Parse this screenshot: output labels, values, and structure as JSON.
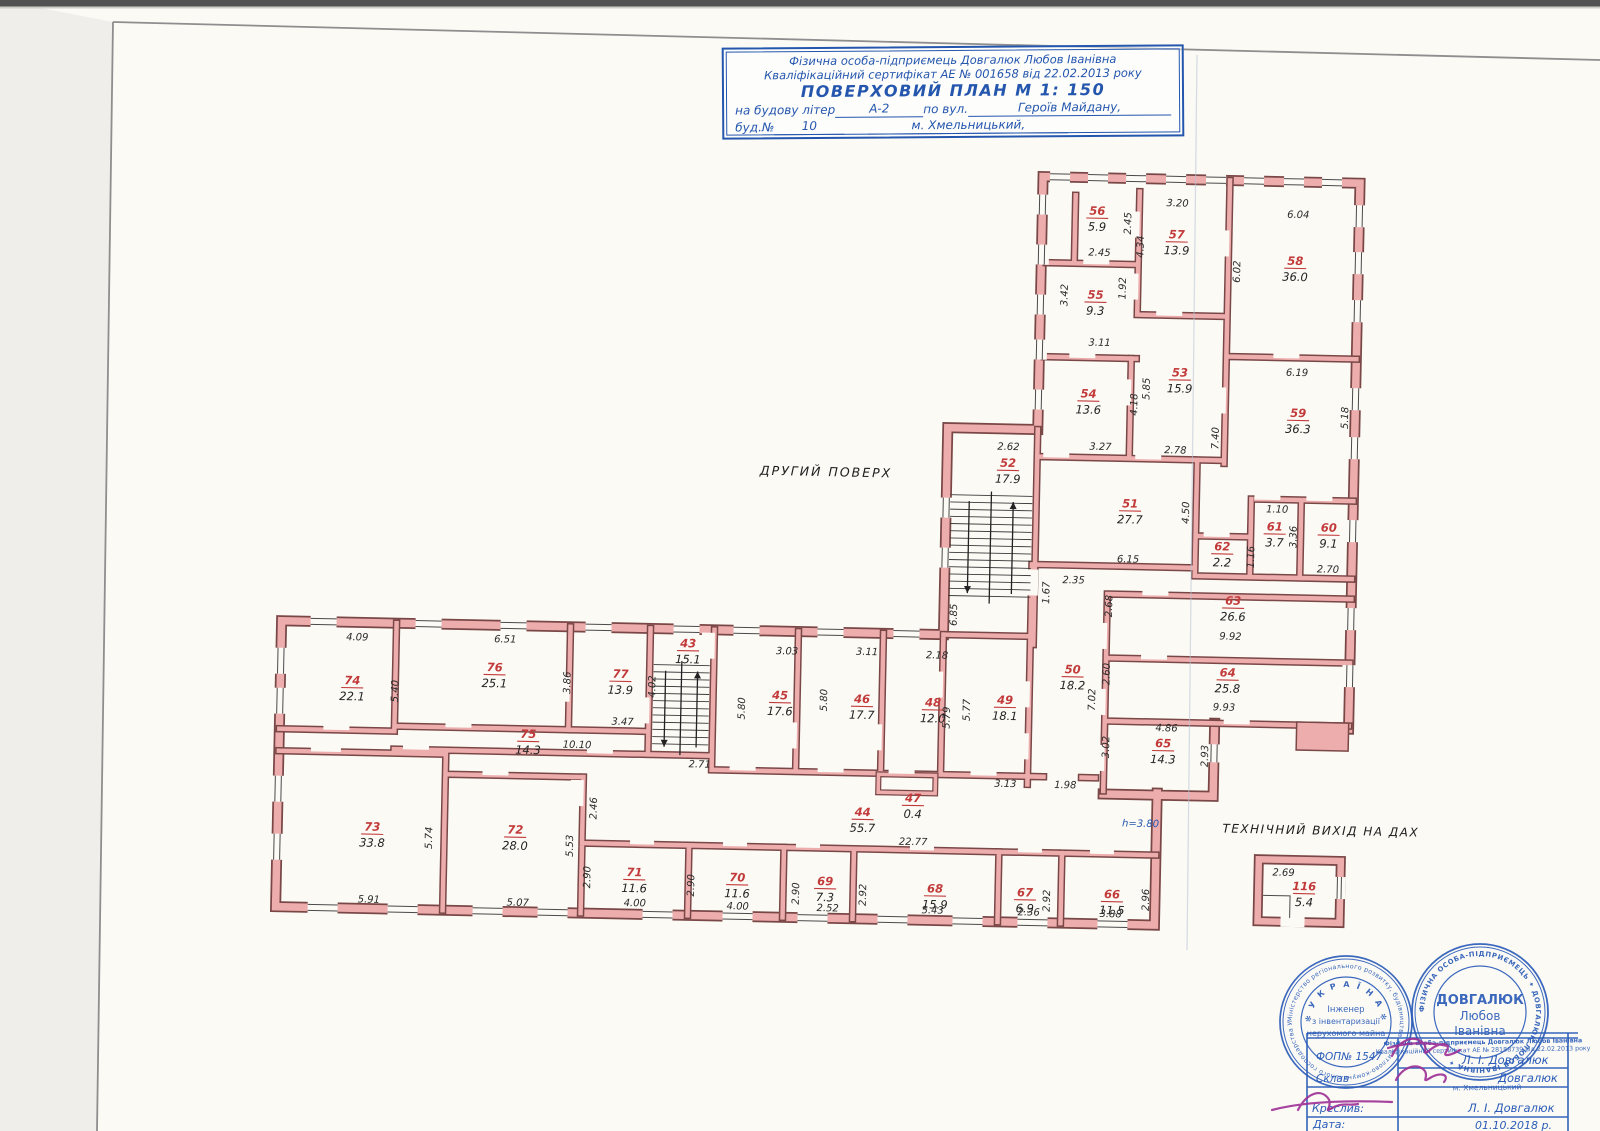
{
  "title_block": {
    "line1": "Фізична особа-підприємець Довгалюк Любов Іванівна",
    "line2": "Кваліфікаційний сертифікат АЕ №  001658  від  22.02.2013  року",
    "line3": "ПОВЕРХОВИЙ  ПЛАН    М 1: 150",
    "line4a": "на  будову  літер",
    "line4b": "А-2",
    "line4c": "по  вул.",
    "line4d": "Героїв  Майдану,",
    "line5a": "буд.№",
    "line5b": "10",
    "line5c": "м.  Хмельницький,"
  },
  "plan": {
    "floor_label": "ДРУГИЙ  ПОВЕРХ",
    "roof_label": "ТЕХНІЧНИЙ  ВИХІД  НА  ДАХ",
    "rooms": [
      {
        "n": "74",
        "a": "22.1",
        "x": 355,
        "y": 694
      },
      {
        "n": "76",
        "a": "25.1",
        "x": 497,
        "y": 678
      },
      {
        "n": "77",
        "a": "13.9",
        "x": 623,
        "y": 682
      },
      {
        "n": "43",
        "a": "15.1",
        "x": 690,
        "y": 650
      },
      {
        "n": "75",
        "a": "14.3",
        "x": 532,
        "y": 744
      },
      {
        "n": "45",
        "a": "17.6",
        "x": 783,
        "y": 700
      },
      {
        "n": "46",
        "a": "17.7",
        "x": 865,
        "y": 702
      },
      {
        "n": "48",
        "a": "12.0",
        "x": 936,
        "y": 704
      },
      {
        "n": "49",
        "a": "18.1",
        "x": 1008,
        "y": 700
      },
      {
        "n": "44",
        "a": "55.7",
        "x": 868,
        "y": 815
      },
      {
        "n": "47",
        "a": "0.4",
        "x": 918,
        "y": 800
      },
      {
        "n": "73",
        "a": "33.8",
        "x": 378,
        "y": 840
      },
      {
        "n": "72",
        "a": "28.0",
        "x": 521,
        "y": 840
      },
      {
        "n": "71",
        "a": "11.6",
        "x": 641,
        "y": 880
      },
      {
        "n": "70",
        "a": "11.6",
        "x": 744,
        "y": 883
      },
      {
        "n": "69",
        "a": "7.3",
        "x": 832,
        "y": 885
      },
      {
        "n": "68",
        "a": "15.9",
        "x": 942,
        "y": 890
      },
      {
        "n": "67",
        "a": "6.9",
        "x": 1032,
        "y": 892
      },
      {
        "n": "66",
        "a": "11.5",
        "x": 1119,
        "y": 892
      },
      {
        "n": "56",
        "a": "5.9",
        "x": 1090,
        "y": 209
      },
      {
        "n": "57",
        "a": "13.9",
        "x": 1170,
        "y": 231
      },
      {
        "n": "58",
        "a": "36.0",
        "x": 1289,
        "y": 255
      },
      {
        "n": "55",
        "a": "9.3",
        "x": 1090,
        "y": 293
      },
      {
        "n": "54",
        "a": "13.6",
        "x": 1085,
        "y": 392
      },
      {
        "n": "53",
        "a": "15.9",
        "x": 1176,
        "y": 369
      },
      {
        "n": "59",
        "a": "36.3",
        "x": 1295,
        "y": 407
      },
      {
        "n": "52",
        "a": "17.9",
        "x": 1006,
        "y": 463
      },
      {
        "n": "51",
        "a": "27.7",
        "x": 1129,
        "y": 501
      },
      {
        "n": "62",
        "a": "2.2",
        "x": 1222,
        "y": 542
      },
      {
        "n": "61",
        "a": "3.7",
        "x": 1274,
        "y": 521
      },
      {
        "n": "60",
        "a": "9.1",
        "x": 1328,
        "y": 521
      },
      {
        "n": "50",
        "a": "18.2",
        "x": 1075,
        "y": 668
      },
      {
        "n": "63",
        "a": "26.6",
        "x": 1234,
        "y": 596
      },
      {
        "n": "64",
        "a": "25.8",
        "x": 1230,
        "y": 668
      },
      {
        "n": "65",
        "a": "14.3",
        "x": 1167,
        "y": 740
      },
      {
        "n": "116",
        "a": "5.4",
        "x": 1311,
        "y": 880
      }
    ],
    "dims": [
      {
        "v": "4.09",
        "x": 359,
        "y": 650
      },
      {
        "v": "6.51",
        "x": 507,
        "y": 649
      },
      {
        "v": "5.40",
        "x": 401,
        "y": 700,
        "r": 1
      },
      {
        "v": "3.86",
        "x": 573,
        "y": 688,
        "r": 1
      },
      {
        "v": "4.02",
        "x": 658,
        "y": 690,
        "r": 1
      },
      {
        "v": "3.47",
        "x": 626,
        "y": 729
      },
      {
        "v": "10.10",
        "x": 581,
        "y": 753
      },
      {
        "v": "2.71",
        "x": 704,
        "y": 770
      },
      {
        "v": "3.03",
        "x": 789,
        "y": 655
      },
      {
        "v": "3.11",
        "x": 869,
        "y": 654
      },
      {
        "v": "2.18",
        "x": 939,
        "y": 656
      },
      {
        "v": "5.80",
        "x": 748,
        "y": 710,
        "r": 1
      },
      {
        "v": "5.80",
        "x": 830,
        "y": 700,
        "r": 1
      },
      {
        "v": "5.79",
        "x": 953,
        "y": 715,
        "r": 1
      },
      {
        "v": "5.77",
        "x": 973,
        "y": 707,
        "r": 1
      },
      {
        "v": "3.13",
        "x": 1010,
        "y": 783
      },
      {
        "v": "1.98",
        "x": 1070,
        "y": 783
      },
      {
        "v": "22.77",
        "x": 919,
        "y": 843
      },
      {
        "v": "2.46",
        "x": 602,
        "y": 813,
        "r": 1
      },
      {
        "v": "5.53",
        "x": 579,
        "y": 851,
        "r": 1
      },
      {
        "v": "5.74",
        "x": 438,
        "y": 846,
        "r": 1
      },
      {
        "v": "5.91",
        "x": 376,
        "y": 912
      },
      {
        "v": "5.07",
        "x": 525,
        "y": 912
      },
      {
        "v": "2.90",
        "x": 597,
        "y": 882,
        "r": 1
      },
      {
        "v": "4.00",
        "x": 642,
        "y": 910
      },
      {
        "v": "2.90",
        "x": 701,
        "y": 888,
        "r": 1
      },
      {
        "v": "4.00",
        "x": 745,
        "y": 911
      },
      {
        "v": "2.90",
        "x": 806,
        "y": 894,
        "r": 1
      },
      {
        "v": "2.52",
        "x": 835,
        "y": 911
      },
      {
        "v": "2.92",
        "x": 873,
        "y": 894,
        "r": 1
      },
      {
        "v": "5.43",
        "x": 940,
        "y": 911
      },
      {
        "v": "2.36",
        "x": 1036,
        "y": 911
      },
      {
        "v": "2.92",
        "x": 1057,
        "y": 896,
        "r": 1
      },
      {
        "v": "3.88",
        "x": 1118,
        "y": 911
      },
      {
        "v": "2.96",
        "x": 1156,
        "y": 893,
        "r": 1
      },
      {
        "v": "h=3.80",
        "x": 1146,
        "y": 820,
        "c": 1
      },
      {
        "v": "2.62",
        "x": 1006,
        "y": 446
      },
      {
        "v": "6.85",
        "x": 958,
        "y": 612,
        "r": 1
      },
      {
        "v": "2.45",
        "x": 1124,
        "y": 217,
        "r": 1
      },
      {
        "v": "3.20",
        "x": 1170,
        "y": 199
      },
      {
        "v": "6.04",
        "x": 1291,
        "y": 208
      },
      {
        "v": "2.45",
        "x": 1093,
        "y": 250
      },
      {
        "v": "4.34",
        "x": 1137,
        "y": 240,
        "r": 1
      },
      {
        "v": "6.02",
        "x": 1234,
        "y": 263,
        "r": 1
      },
      {
        "v": "1.92",
        "x": 1120,
        "y": 282,
        "r": 1
      },
      {
        "v": "3.42",
        "x": 1062,
        "y": 290,
        "r": 1
      },
      {
        "v": "3.11",
        "x": 1095,
        "y": 340
      },
      {
        "v": "5.85",
        "x": 1146,
        "y": 382,
        "r": 1
      },
      {
        "v": "4.18",
        "x": 1134,
        "y": 398,
        "r": 1
      },
      {
        "v": "6.19",
        "x": 1293,
        "y": 366
      },
      {
        "v": "3.27",
        "x": 1098,
        "y": 444
      },
      {
        "v": "2.78",
        "x": 1173,
        "y": 446
      },
      {
        "v": "7.40",
        "x": 1216,
        "y": 430,
        "r": 1
      },
      {
        "v": "5.18",
        "x": 1345,
        "y": 407,
        "r": 1
      },
      {
        "v": "1.10",
        "x": 1276,
        "y": 503
      },
      {
        "v": "3.36",
        "x": 1296,
        "y": 527,
        "r": 1
      },
      {
        "v": "2.70",
        "x": 1328,
        "y": 562
      },
      {
        "v": "1.16",
        "x": 1254,
        "y": 548,
        "r": 1
      },
      {
        "v": "4.50",
        "x": 1188,
        "y": 505,
        "r": 1
      },
      {
        "v": "6.15",
        "x": 1128,
        "y": 556
      },
      {
        "v": "2.35",
        "x": 1074,
        "y": 578
      },
      {
        "v": "1.67",
        "x": 1050,
        "y": 588,
        "r": 1
      },
      {
        "v": "2.68",
        "x": 1113,
        "y": 600,
        "r": 1
      },
      {
        "v": "2.60",
        "x": 1112,
        "y": 668,
        "r": 1
      },
      {
        "v": "7.02",
        "x": 1098,
        "y": 694,
        "r": 1
      },
      {
        "v": "3.02",
        "x": 1113,
        "y": 741,
        "r": 1
      },
      {
        "v": "9.92",
        "x": 1232,
        "y": 631
      },
      {
        "v": "9.93",
        "x": 1227,
        "y": 702
      },
      {
        "v": "4.86",
        "x": 1170,
        "y": 724
      },
      {
        "v": "2.93",
        "x": 1212,
        "y": 748,
        "r": 1
      },
      {
        "v": "2.69",
        "x": 1290,
        "y": 866
      }
    ]
  },
  "stamps": {
    "round1": {
      "ring": "Міністерство регіонального розвитку, будівництва та житлово-комунального господарства України ✻ Атестаційна архітектурно-будівельна комісія ✻",
      "arc": "✻ У К Р А Ї Н А ✻",
      "l1": "Інженер",
      "l2": "з інвентаризації",
      "l3": "нерухомого майна"
    },
    "round2": {
      "ring": "ФІЗИЧНА ОСОБА-ПІДПРИЄМЕЦЬ ✦ ДОВГАЛЮК ЛЮБОВ ІВАНІВНА ✦",
      "n1": "ДОВГАЛЮК",
      "n2": "Любов",
      "n3": "Іванівна"
    },
    "rect": {
      "l1": "Фізична особа-підприємець Довгалюк Любов Іванівна",
      "l2": "Кваліфікаційний сертифікат АЕ № 28188739 від 22.02.2013 року",
      "l3": "м. Хмельницький"
    }
  },
  "sig_table": {
    "r1_label": "ФОП№ 1547",
    "r1_value": "Л. І. Довгалюк",
    "r2_label": "Склав",
    "r2_value": "Довгалюк",
    "r3_label": "Креслив:",
    "r3_value": "Л. І. Довгалюк",
    "r4_label": "Дата:",
    "r4_value": "01.10.2018 р."
  }
}
